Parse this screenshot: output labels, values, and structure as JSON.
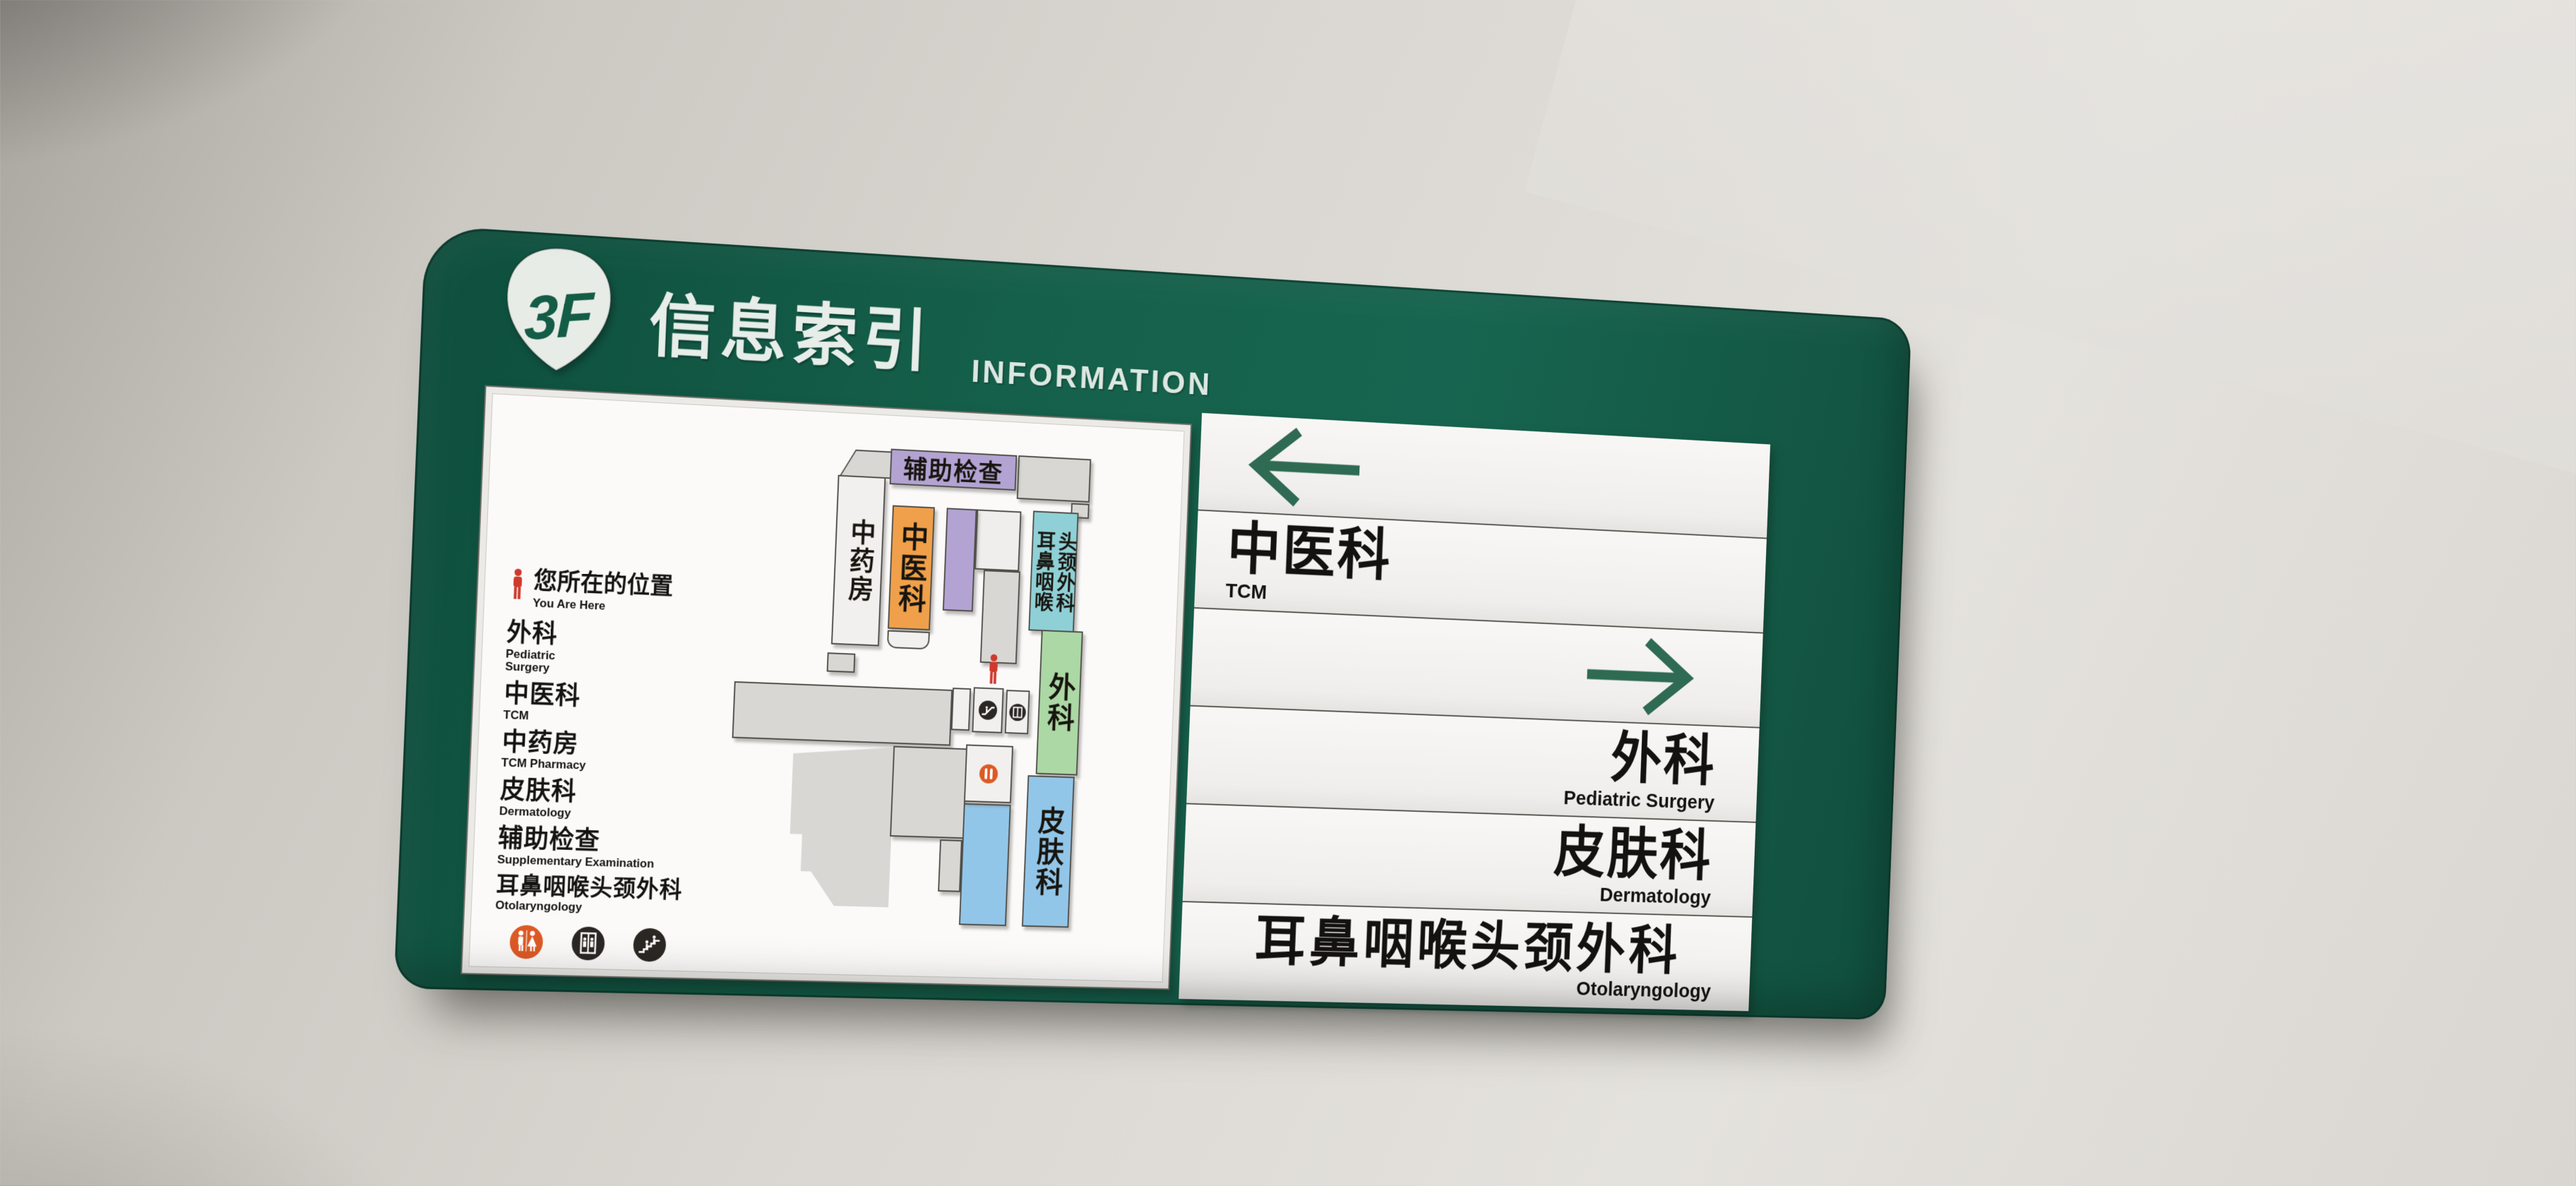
{
  "header": {
    "floor": "3F",
    "title_zh": "信息索引",
    "title_en": "INFORMATION"
  },
  "directory": {
    "rows": [
      {
        "type": "arrow",
        "direction": "left"
      },
      {
        "type": "entry",
        "zh": "中医科",
        "en": "TCM",
        "align": "left"
      },
      {
        "type": "arrow",
        "direction": "right"
      },
      {
        "type": "entry",
        "zh": "外科",
        "en": "Pediatric Surgery",
        "align": "right"
      },
      {
        "type": "entry",
        "zh": "皮肤科",
        "en": "Dermatology",
        "align": "right"
      },
      {
        "type": "entry",
        "zh": "耳鼻咽喉头颈外科",
        "en": "Otolaryngology",
        "align": "right"
      }
    ]
  },
  "map_panel": {
    "legend": {
      "you_are_here": {
        "zh": "您所在的位置",
        "en": "You Are Here"
      },
      "items": [
        {
          "zh": "外科",
          "en": "Pediatric\nSurgery"
        },
        {
          "zh": "中医科",
          "en": "TCM"
        },
        {
          "zh": "中药房",
          "en": "TCM Pharmacy"
        },
        {
          "zh": "皮肤科",
          "en": "Dermatology"
        },
        {
          "zh": "辅助检查",
          "en": "Supplementary Examination"
        },
        {
          "zh": "耳鼻咽喉头颈外科",
          "en": "Otolaryngology"
        }
      ],
      "icons": [
        "restroom-icon",
        "elevator-icon",
        "escalator-icon"
      ]
    },
    "blocks": {
      "aux_exam": {
        "label": "辅助检查",
        "color": "#b3a3d3"
      },
      "tcm_pharmacy": {
        "label": "中药房",
        "color": "#f1f0ee"
      },
      "tcm": {
        "label": "中医科",
        "color": "#f0a04a"
      },
      "ent": {
        "label": "耳鼻咽喉\n头颈外科",
        "color": "#8fd0d6"
      },
      "surgery": {
        "label": "外科",
        "color": "#abd8a4"
      },
      "dermatology": {
        "label": "皮肤科",
        "color": "#92c6e9"
      }
    }
  },
  "colors": {
    "board_green": "#15604a",
    "arrow_green": "#2e6b52",
    "marker_red": "#cf3a2d",
    "restroom_orange": "#dd5a25",
    "icon_black": "#2b2824"
  }
}
